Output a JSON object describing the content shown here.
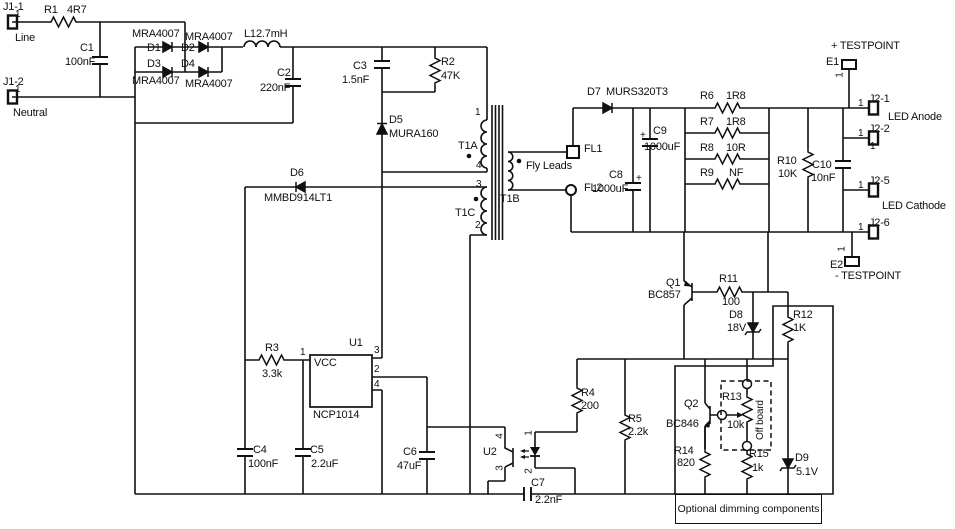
{
  "diagram": {
    "kind": "circuit-schematic",
    "description": "Offline flyback LED driver schematic with NCP1014 controller and optional dimming section",
    "ink_color": "#101010",
    "background_color": "#ffffff"
  },
  "annotations": {
    "optional_box": "Optional dimming components",
    "off_board": "Off board",
    "fly_leads": "Fly Leads"
  },
  "components": [
    {
      "name": "resistor-r1",
      "ref": "R1",
      "ref_xy": [
        44,
        5
      ],
      "value": "4R7",
      "val_xy": [
        67,
        5
      ]
    },
    {
      "name": "capacitor-c1",
      "ref": "C1",
      "ref_xy": [
        80,
        43
      ],
      "value": "100nF",
      "val_xy": [
        65,
        57
      ]
    },
    {
      "name": "diode-d1",
      "ref": "D1",
      "ref_xy": [
        147,
        43
      ],
      "part": "MRA4007",
      "part_xy": [
        132,
        29
      ]
    },
    {
      "name": "diode-d2",
      "ref": "D2",
      "ref_xy": [
        181,
        43
      ],
      "part": "MRA4007",
      "part_xy": [
        185,
        32
      ]
    },
    {
      "name": "diode-d3",
      "ref": "D3",
      "ref_xy": [
        147,
        59
      ],
      "part": "MRA4007",
      "part_xy": [
        132,
        76
      ]
    },
    {
      "name": "diode-d4",
      "ref": "D4",
      "ref_xy": [
        181,
        59
      ],
      "part": "MRA4007",
      "part_xy": [
        185,
        79
      ]
    },
    {
      "name": "inductor-l1",
      "ref": "L1",
      "ref_xy": [
        244,
        29
      ],
      "value": "2.7mH",
      "val_xy": [
        256,
        29
      ]
    },
    {
      "name": "capacitor-c2",
      "ref": "C2",
      "ref_xy": [
        277,
        68
      ],
      "value": "220nF",
      "val_xy": [
        260,
        83
      ]
    },
    {
      "name": "capacitor-c3",
      "ref": "C3",
      "ref_xy": [
        353,
        61
      ],
      "value": "1.5nF",
      "val_xy": [
        342,
        75
      ]
    },
    {
      "name": "resistor-r2",
      "ref": "R2",
      "ref_xy": [
        441,
        57
      ],
      "value": "47K",
      "val_xy": [
        441,
        71
      ]
    },
    {
      "name": "diode-d5",
      "ref": "D5",
      "ref_xy": [
        389,
        115
      ],
      "part": "MURA160",
      "part_xy": [
        389,
        129
      ]
    },
    {
      "name": "diode-d6",
      "ref": "D6",
      "ref_xy": [
        290,
        168
      ],
      "part": "MMBD914LT1",
      "part_xy": [
        264,
        193
      ]
    },
    {
      "name": "resistor-r3",
      "ref": "R3",
      "ref_xy": [
        265,
        343
      ],
      "value": "3.3k",
      "val_xy": [
        262,
        369
      ]
    },
    {
      "name": "ic-u1",
      "ref": "U1",
      "ref_xy": [
        349,
        338
      ],
      "part": "NCP1014",
      "part_xy": [
        313,
        410
      ]
    },
    {
      "name": "capacitor-c4",
      "ref": "C4",
      "ref_xy": [
        253,
        445
      ],
      "value": "100nF",
      "val_xy": [
        248,
        459
      ]
    },
    {
      "name": "capacitor-c5",
      "ref": "C5",
      "ref_xy": [
        310,
        445
      ],
      "value": "2.2uF",
      "val_xy": [
        311,
        459
      ]
    },
    {
      "name": "capacitor-c6",
      "ref": "C6",
      "ref_xy": [
        403,
        447
      ],
      "value": "47uF",
      "val_xy": [
        397,
        461
      ]
    },
    {
      "name": "capacitor-c7",
      "ref": "C7",
      "ref_xy": [
        531,
        478
      ],
      "value": "2.2nF",
      "val_xy": [
        535,
        495
      ]
    },
    {
      "name": "optocoupler-u2",
      "ref": "U2",
      "ref_xy": [
        483,
        447
      ]
    },
    {
      "name": "resistor-r4",
      "ref": "R4",
      "ref_xy": [
        581,
        388
      ],
      "value": "200",
      "val_xy": [
        581,
        401
      ]
    },
    {
      "name": "resistor-r5",
      "ref": "R5",
      "ref_xy": [
        628,
        414
      ],
      "value": "2.2k",
      "val_xy": [
        628,
        427
      ]
    },
    {
      "name": "diode-d7",
      "ref": "D7",
      "ref_xy": [
        587,
        87
      ],
      "part": "MURS320T3",
      "part_xy": [
        606,
        87
      ]
    },
    {
      "name": "capacitor-c8",
      "ref": "C8",
      "ref_xy": [
        609,
        170
      ],
      "value": "1000uF",
      "val_xy": [
        592,
        184
      ]
    },
    {
      "name": "capacitor-c9",
      "ref": "C9",
      "ref_xy": [
        653,
        126
      ],
      "value": "1000uF",
      "val_xy": [
        644,
        142
      ]
    },
    {
      "name": "resistor-r6",
      "ref": "R6",
      "ref_xy": [
        700,
        91
      ],
      "value": "1R8",
      "val_xy": [
        726,
        91
      ]
    },
    {
      "name": "resistor-r7",
      "ref": "R7",
      "ref_xy": [
        700,
        117
      ],
      "value": "1R8",
      "val_xy": [
        726,
        117
      ]
    },
    {
      "name": "resistor-r8",
      "ref": "R8",
      "ref_xy": [
        700,
        143
      ],
      "value": "10R",
      "val_xy": [
        726,
        143
      ]
    },
    {
      "name": "resistor-r9",
      "ref": "R9",
      "ref_xy": [
        700,
        168
      ],
      "value": "NF",
      "val_xy": [
        729,
        168
      ]
    },
    {
      "name": "resistor-r10",
      "ref": "R10",
      "ref_xy": [
        777,
        156
      ],
      "value": "10K",
      "val_xy": [
        778,
        169
      ]
    },
    {
      "name": "capacitor-c10",
      "ref": "C10",
      "ref_xy": [
        812,
        160
      ],
      "value": "10nF",
      "val_xy": [
        811,
        173
      ]
    },
    {
      "name": "transistor-q1",
      "ref": "Q1",
      "ref_xy": [
        666,
        278
      ],
      "part": "BC857",
      "part_xy": [
        648,
        290
      ]
    },
    {
      "name": "resistor-r11",
      "ref": "R11",
      "ref_xy": [
        719,
        274
      ],
      "value": "100",
      "val_xy": [
        722,
        297
      ]
    },
    {
      "name": "diode-d8",
      "ref": "D8",
      "ref_xy": [
        729,
        310
      ],
      "value": "18V",
      "val_xy": [
        727,
        323
      ]
    },
    {
      "name": "resistor-r12",
      "ref": "R12",
      "ref_xy": [
        793,
        310
      ],
      "value": "1K",
      "val_xy": [
        793,
        323
      ]
    },
    {
      "name": "transistor-q2",
      "ref": "Q2",
      "ref_xy": [
        684,
        399
      ],
      "part": "BC846",
      "part_xy": [
        666,
        419
      ]
    },
    {
      "name": "potentiometer-r13",
      "ref": "R13",
      "ref_xy": [
        722,
        392
      ],
      "value": "10k",
      "val_xy": [
        727,
        420
      ]
    },
    {
      "name": "resistor-r14",
      "ref": "R14",
      "ref_xy": [
        674,
        446
      ],
      "value": "820",
      "val_xy": [
        677,
        458
      ]
    },
    {
      "name": "resistor-r15",
      "ref": "R15",
      "ref_xy": [
        749,
        449
      ],
      "value": "1k",
      "val_xy": [
        752,
        463
      ]
    },
    {
      "name": "diode-d9",
      "ref": "D9",
      "ref_xy": [
        795,
        453
      ],
      "value": "5.1V",
      "val_xy": [
        796,
        467
      ]
    }
  ],
  "texts": [
    {
      "name": "connector-j1-1-label",
      "text": "J1-1",
      "x": 3,
      "y": 2
    },
    {
      "name": "connector-j1-1-pin",
      "text": "1",
      "x": 15,
      "y": 10,
      "cls": "s10"
    },
    {
      "name": "line-label",
      "text": "Line",
      "x": 15,
      "y": 33
    },
    {
      "name": "connector-j1-2-label",
      "text": "J1-2",
      "x": 3,
      "y": 77
    },
    {
      "name": "connector-j1-2-pin",
      "text": "1",
      "x": 15,
      "y": 85,
      "cls": "s10"
    },
    {
      "name": "neutral-label",
      "text": "Neutral",
      "x": 13,
      "y": 108
    },
    {
      "name": "u1-vcc-label",
      "text": "VCC",
      "x": 314,
      "y": 358
    },
    {
      "name": "u1-pin1",
      "text": "1",
      "x": 300,
      "y": 348,
      "cls": "s10"
    },
    {
      "name": "u1-pin3",
      "text": "3",
      "x": 374,
      "y": 346,
      "cls": "s10"
    },
    {
      "name": "u1-pin2",
      "text": "2",
      "x": 374,
      "y": 365,
      "cls": "s10"
    },
    {
      "name": "u1-pin4",
      "text": "4",
      "x": 374,
      "y": 380,
      "cls": "s10"
    },
    {
      "name": "t1a-label",
      "text": "T1A",
      "x": 458,
      "y": 141
    },
    {
      "name": "t1a-pin1",
      "text": "1",
      "x": 475,
      "y": 108,
      "cls": "s10"
    },
    {
      "name": "t1a-pin4",
      "text": "4",
      "x": 476,
      "y": 161,
      "cls": "s10"
    },
    {
      "name": "t1c-pin3",
      "text": "3",
      "x": 476,
      "y": 180,
      "cls": "s10"
    },
    {
      "name": "t1c-pin2",
      "text": "2",
      "x": 475,
      "y": 221,
      "cls": "s10"
    },
    {
      "name": "t1c-label",
      "text": "T1C",
      "x": 455,
      "y": 208
    },
    {
      "name": "t1b-label",
      "text": "T1B",
      "x": 500,
      "y": 194
    },
    {
      "name": "fly-leads-label",
      "text": "Fly Leads",
      "x": 526,
      "y": 161
    },
    {
      "name": "fl1-label",
      "text": "FL1",
      "x": 584,
      "y": 144
    },
    {
      "name": "fl2-label",
      "text": "FL2",
      "x": 584,
      "y": 183
    },
    {
      "name": "c8-plus",
      "text": "+",
      "x": 636,
      "y": 174,
      "cls": "s10"
    },
    {
      "name": "c9-plus",
      "text": "+",
      "x": 640,
      "y": 131,
      "cls": "s10"
    },
    {
      "name": "e1-label",
      "text": "E1",
      "x": 826,
      "y": 57
    },
    {
      "name": "e1-pin",
      "text": "1",
      "x": 838,
      "y": 70,
      "rot": -90,
      "cls": "s10"
    },
    {
      "name": "testpoint-plus-label",
      "text": "+ TESTPOINT",
      "x": 831,
      "y": 41
    },
    {
      "name": "j2-1-label",
      "text": "J2-1",
      "x": 869,
      "y": 94
    },
    {
      "name": "j2-1-pin",
      "text": "1",
      "x": 858,
      "y": 99,
      "cls": "s10"
    },
    {
      "name": "j2-2-label",
      "text": "J2-2",
      "x": 869,
      "y": 124
    },
    {
      "name": "j2-2-pin",
      "text": "1",
      "x": 858,
      "y": 129,
      "cls": "s10"
    },
    {
      "name": "j2-2-pin-b",
      "text": "1",
      "x": 870,
      "y": 142,
      "cls": "s10"
    },
    {
      "name": "led-anode-label",
      "text": "LED Anode",
      "x": 888,
      "y": 112
    },
    {
      "name": "j2-5-label",
      "text": "J2-5",
      "x": 869,
      "y": 176
    },
    {
      "name": "j2-5-pin",
      "text": "1",
      "x": 858,
      "y": 181,
      "cls": "s10"
    },
    {
      "name": "led-cathode-label",
      "text": "LED Cathode",
      "x": 882,
      "y": 201
    },
    {
      "name": "j2-6-label",
      "text": "J2-6",
      "x": 869,
      "y": 218
    },
    {
      "name": "j2-6-pin",
      "text": "1",
      "x": 858,
      "y": 223,
      "cls": "s10"
    },
    {
      "name": "e2-label",
      "text": "E2",
      "x": 830,
      "y": 260
    },
    {
      "name": "e2-pin",
      "text": "1",
      "x": 840,
      "y": 244,
      "rot": -90,
      "cls": "s10"
    },
    {
      "name": "testpoint-minus-label",
      "text": "- TESTPOINT",
      "x": 835,
      "y": 271
    },
    {
      "name": "u2-pin4",
      "text": "4",
      "x": 498,
      "y": 431,
      "rot": -90,
      "cls": "s10"
    },
    {
      "name": "u2-pin3",
      "text": "3",
      "x": 498,
      "y": 463,
      "rot": -90,
      "cls": "s10"
    },
    {
      "name": "u2-pin1",
      "text": "1",
      "x": 527,
      "y": 428,
      "rot": -90,
      "cls": "s10"
    },
    {
      "name": "u2-pin2",
      "text": "2",
      "x": 527,
      "y": 466,
      "rot": -90,
      "cls": "s10"
    },
    {
      "name": "off-board-label",
      "text": "Off board",
      "x": 756,
      "y": 440,
      "rot": -90,
      "origin": "0 0",
      "cls": "s10"
    }
  ]
}
